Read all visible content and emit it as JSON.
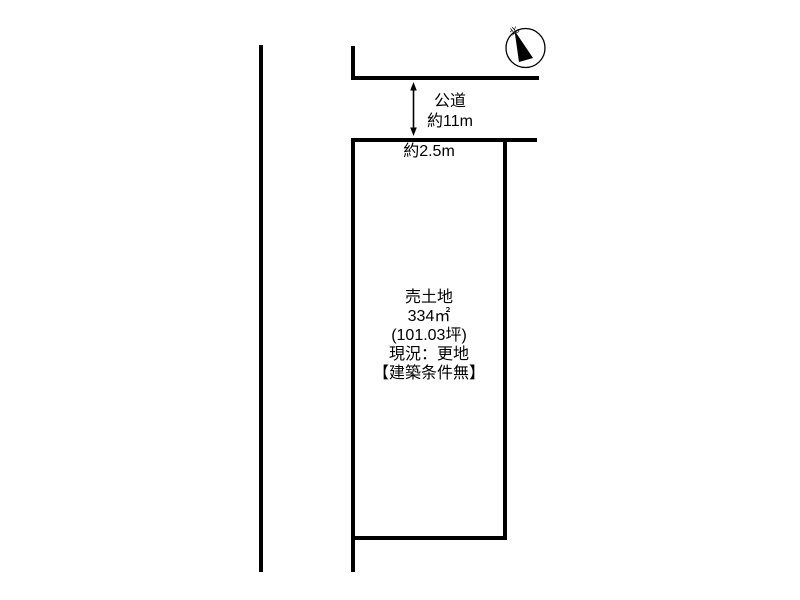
{
  "diagram": {
    "background": "#ffffff",
    "line_color": "#000000",
    "road": {
      "name": "公道",
      "width": "約11m"
    },
    "frontage": "約2.5m",
    "parcel": {
      "type": "売土地",
      "area_sqm": "334㎡",
      "area_tsubo": "(101.03坪)",
      "status": "現況：更地",
      "note": "【建築条件無】"
    },
    "compass": {
      "north": "北"
    }
  }
}
